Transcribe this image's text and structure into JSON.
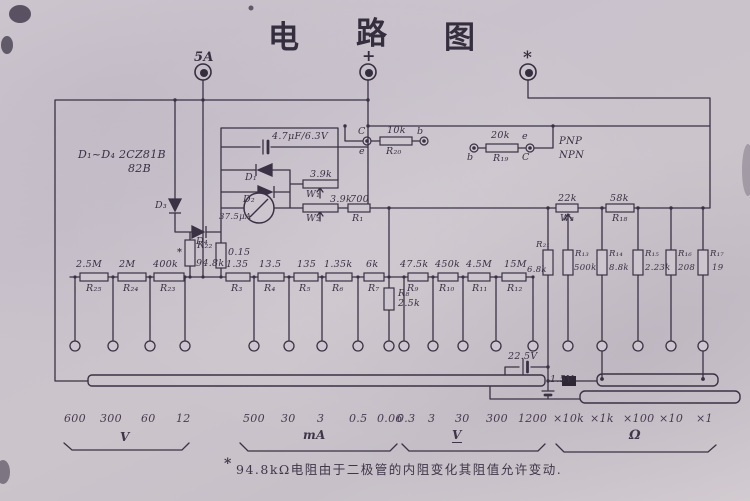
{
  "title": {
    "c1": "电",
    "c2": "路",
    "c3": "图"
  },
  "terminals": {
    "fuse": "5A",
    "plus": "+",
    "star": "*"
  },
  "diode_note": {
    "line1": "D₁~D₄ 2CZ81B",
    "line2": "82B"
  },
  "meter_block": {
    "cap_value": "4.7μF/6.3V",
    "d1": "D₁",
    "d2": "D₂",
    "d3": "D₃",
    "d4": "D₄",
    "meter_value": "37.5μA",
    "w1_value": "3.9k",
    "w1_name": "W₁",
    "w2_value": "3.9k",
    "w2_name": "W₂",
    "r1_value": "700",
    "r1_name": "R₁",
    "r22_name": "R₂₂",
    "r22_star": "*",
    "r22_value": "94.8k",
    "r2_value": "0.15"
  },
  "transistor_left": {
    "c": "C",
    "e": "e",
    "value": "10k",
    "name": "R₂₀",
    "b": "b"
  },
  "transistor_right": {
    "b": "b",
    "value": "20k",
    "name": "R₁₉",
    "e": "e",
    "c": "C",
    "type1": "PNP",
    "type2": "NPN"
  },
  "right_network": {
    "w3_value": "22k",
    "w3_name": "W₃",
    "r18_value": "58k",
    "r18_name": "R₁₈",
    "r21_name": "R₂₁",
    "r21_value": "6.8k",
    "r13_name": "R₁₃",
    "r13_value": "500k",
    "r14_name": "R₁₄",
    "r14_value": "8.8k",
    "r15_name": "R₁₅",
    "r15_value": "2.23k",
    "r16_name": "R₁₆",
    "r16_value": "208",
    "r17_name": "R₁₇",
    "r17_value": "19"
  },
  "chain": [
    {
      "value": "2.5M",
      "name": "R₂₅"
    },
    {
      "value": "2M",
      "name": "R₂₄"
    },
    {
      "value": "400k",
      "name": "R₂₃"
    },
    {
      "value": "1.35",
      "name": "R₃"
    },
    {
      "value": "13.5",
      "name": "R₄"
    },
    {
      "value": "135",
      "name": "R₅"
    },
    {
      "value": "1.35k",
      "name": "R₆"
    },
    {
      "value": "6k",
      "name": "R₇"
    },
    {
      "value": "47.5k",
      "name": "R₉"
    },
    {
      "value": "450k",
      "name": "R₁₀"
    },
    {
      "value": "4.5M",
      "name": "R₁₁"
    },
    {
      "value": "15M",
      "name": "R₁₂"
    }
  ],
  "r8": {
    "name": "R₈",
    "value": "2.5k"
  },
  "batteries": {
    "b1": "22.5V",
    "b2": "1.5V"
  },
  "scales": {
    "vdc": {
      "values": [
        "600",
        "300",
        "60",
        "12"
      ],
      "label": "V"
    },
    "ma": {
      "values": [
        "500",
        "30",
        "3",
        "0.5",
        "0.06"
      ],
      "label": "mA"
    },
    "vac": {
      "values": [
        "0.3",
        "3",
        "30",
        "300",
        "1200"
      ],
      "label": "V"
    },
    "ohm": {
      "values": [
        "×10k",
        "×1k",
        "×100",
        "×10",
        "×1"
      ],
      "label": "Ω"
    }
  },
  "footnote": {
    "marker": "*",
    "text": "94.8kΩ电阻由于二极管的内阻变化其阻值允许变动."
  }
}
